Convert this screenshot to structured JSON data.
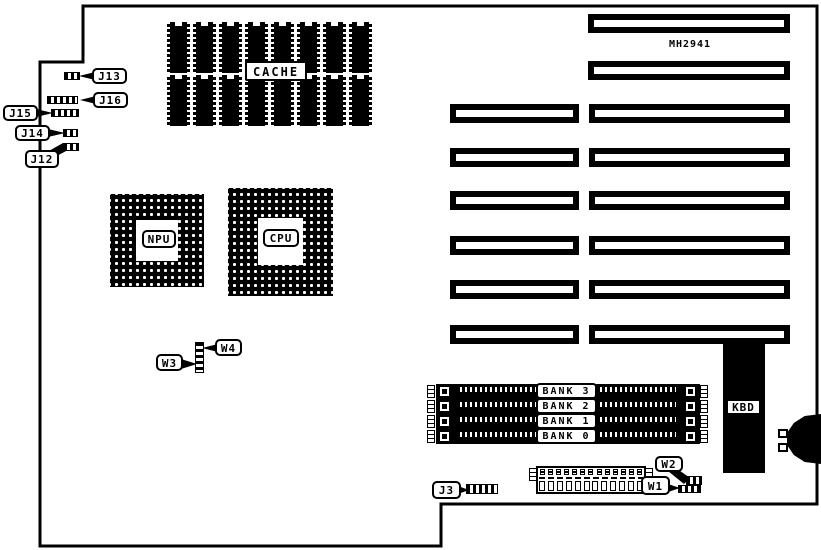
{
  "diagram": {
    "type": "motherboard-layout",
    "board_model": "MH2941",
    "colors": {
      "foreground": "#000000",
      "background": "#ffffff"
    },
    "labels": {
      "j12": "J12",
      "j13": "J13",
      "j14": "J14",
      "j15": "J15",
      "j16": "J16",
      "j3": "J3",
      "w1": "W1",
      "w2": "W2",
      "w3": "W3",
      "w4": "W4",
      "cache": "CACHE",
      "npu": "NPU",
      "cpu": "CPU",
      "kbd": "KBD"
    },
    "memory_banks": [
      "BANK 3",
      "BANK 2",
      "BANK 1",
      "BANK 0"
    ],
    "cache_chips": {
      "rows": 2,
      "per_row": 8
    },
    "expansion_slots": {
      "full_width_top": 2,
      "paired_rows": 6
    },
    "bottom_connector": {
      "top_pads": 13,
      "bottom_pads": 12
    }
  }
}
